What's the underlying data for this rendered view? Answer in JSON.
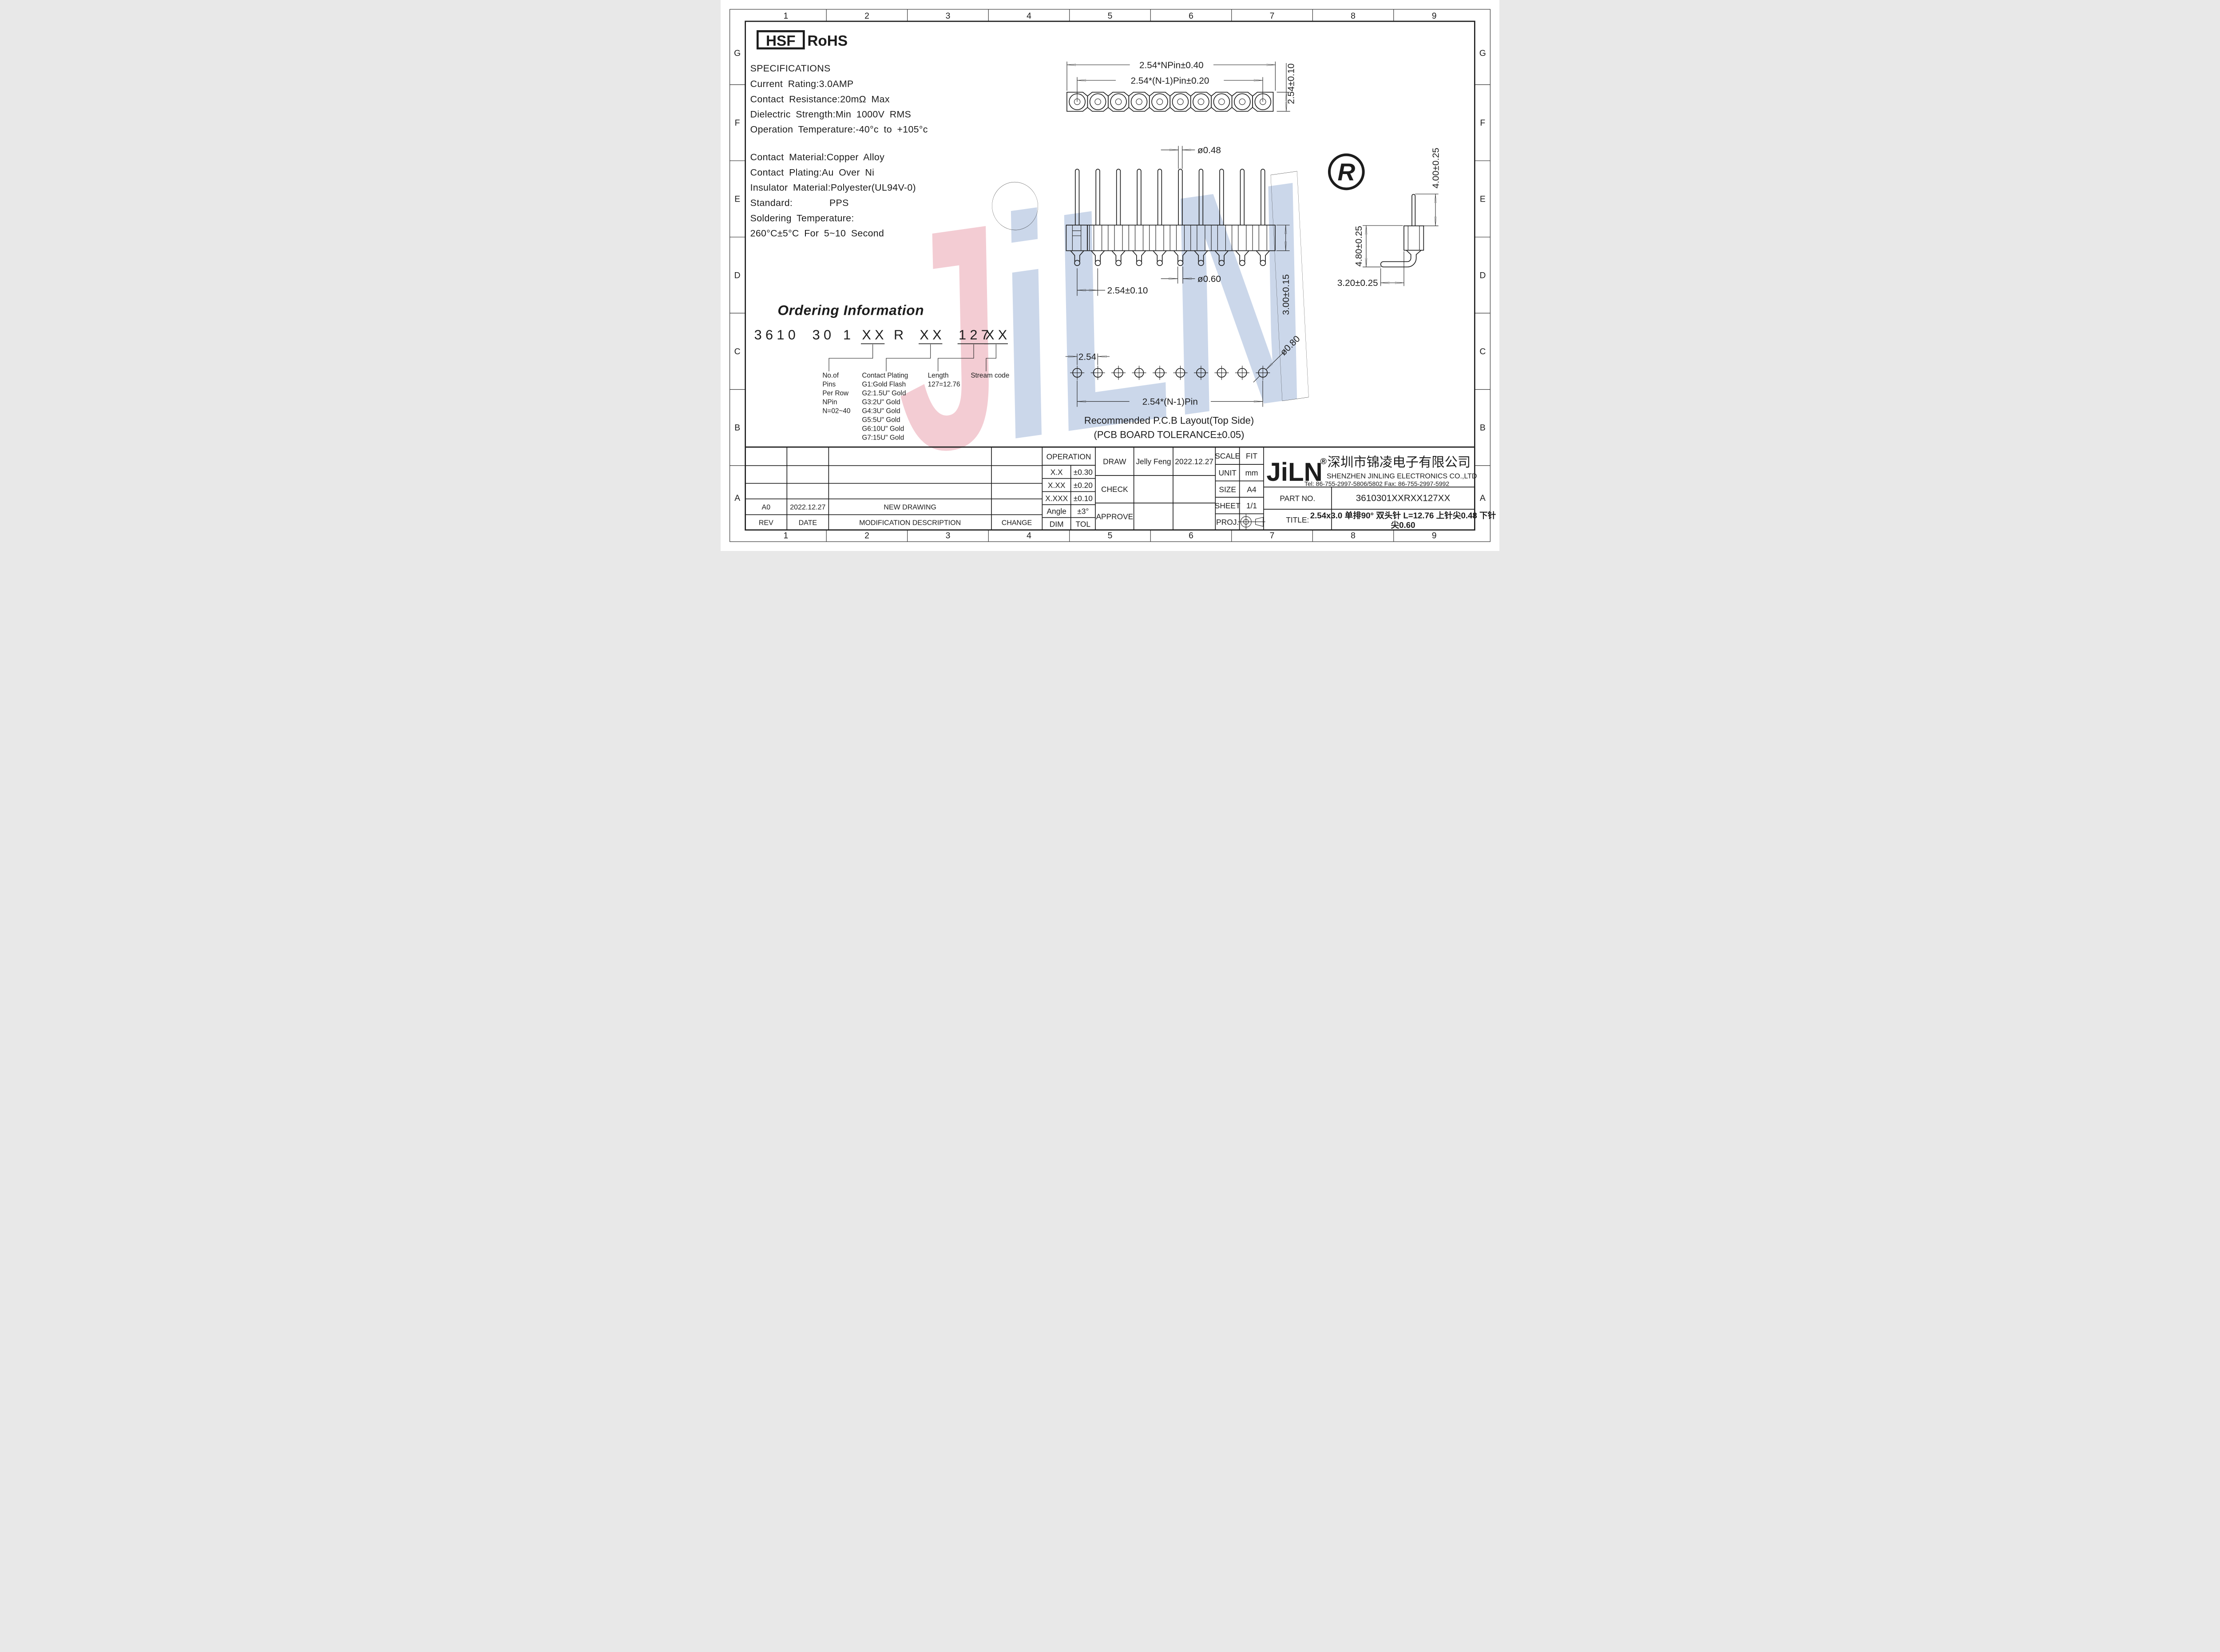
{
  "grid": {
    "columns": [
      "1",
      "2",
      "3",
      "4",
      "5",
      "6",
      "7",
      "8",
      "9"
    ],
    "rows": [
      "G",
      "F",
      "E",
      "D",
      "C",
      "B",
      "A"
    ]
  },
  "badges": {
    "hsf": "HSF",
    "rohs": "RoHS"
  },
  "specifications": {
    "title": "SPECIFICATIONS",
    "current": "Current Rating:3.0AMP",
    "resistance": "Contact Resistance:20mΩ Max",
    "dielectric": "Dielectric Strength:Min 1000V RMS",
    "operation": "Operation Temperature:-40°c to +105°c",
    "material": "Contact Material:Copper Alloy",
    "plating": "Contact Plating:Au Over Ni",
    "insulator": "Insulator Material:Polyester(UL94V-0)",
    "standard_label": "Standard:",
    "standard_value": "PPS",
    "soldering1": "Soldering Temperature:",
    "soldering2": "260°C±5°C For 5~10 Second"
  },
  "ordering": {
    "title": "Ordering Information",
    "tokens": [
      "3610",
      "30",
      "1",
      "XX",
      "R",
      "XX",
      "127",
      "XX"
    ],
    "annotations": {
      "pins": [
        "No.of",
        "Pins",
        "Per Row",
        "NPin",
        "N=02~40"
      ],
      "plating": [
        "Contact Plating",
        "G1:Gold Flash",
        "G2:1.5U\" Gold",
        "G3:2U\" Gold",
        "G4:3U\" Gold",
        "G5:5U\" Gold",
        "G6:10U\" Gold",
        "G7:15U\" Gold"
      ],
      "length": [
        "Length",
        "127=12.76"
      ],
      "stream": [
        "Stream code"
      ]
    }
  },
  "drawings": {
    "top_view": {
      "pin_count": 10,
      "dim_overall": "2.54*NPin±0.40",
      "dim_inner": "2.54*(N-1)Pin±0.20",
      "dim_height": "2.54±0.10"
    },
    "side_view": {
      "pin_count": 10,
      "dim_top_pin": "ø0.48",
      "dim_bottom_pin": "ø0.60",
      "dim_pitch": "2.54±0.10",
      "dim_body": "3.00±0.15"
    },
    "angle_view": {
      "dim_top": "4.00±0.25",
      "dim_vert": "4.80±0.25",
      "dim_horiz": "3.20±0.25"
    },
    "pcb": {
      "pin_count": 10,
      "dim_pitch": "2.54",
      "dim_overall": "2.54*(N-1)Pin",
      "dim_hole": "ø0.80",
      "caption_1": "Recommended P.C.B Layout(Top Side)",
      "caption_2": "(PCB BOARD TOLERANCE±0.05)"
    }
  },
  "title_block": {
    "operation": "OPERATION",
    "r1c1": "X.X",
    "r1c2": "±0.30",
    "r2c1": "X.XX",
    "r2c2": "±0.20",
    "r3c1": "X.XXX",
    "r3c2": "±0.10",
    "r4c1": "Angle",
    "r4c2": "±3°",
    "r5c1": "DIM",
    "r5c2": "TOL",
    "draw": "DRAW",
    "check": "CHECK",
    "approve": "APPROVE",
    "draw_name": "Jelly Feng",
    "draw_date": "2022.12.27",
    "scale_l": "SCALE",
    "scale_v": "FIT",
    "unit_l": "UNIT",
    "unit_v": "mm",
    "size_l": "SIZE",
    "size_v": "A4",
    "sheet_l": "SHEET",
    "sheet_v": "1/1",
    "proj_l": "PROJ.",
    "logo": "JiLN",
    "reg": "®",
    "company_cn": "深圳市锦凌电子有限公司",
    "company_en": "SHENZHEN JINLING ELECTRONICS CO.,LTD",
    "tel": "Tel: 86-755-2997-5806/5802  Fax: 86-755-2997-5992",
    "part_label": "PART NO.",
    "part_value": "3610301XXRXX127XX",
    "title_label": "TITLE:",
    "title_1": "2.54x3.0 单排90° 双头针 L=12.76 上针尖0.48 下针",
    "title_2": "尖0.60",
    "rev": "REV",
    "date": "DATE",
    "mod": "MODIFICATION DESCRIPTION",
    "change": "CHANGE",
    "rev_a0": "A0",
    "rev_a0_date": "2022.12.27",
    "rev_a0_desc": "NEW DRAWING"
  },
  "watermark": {
    "j": "J",
    "i": "i",
    "ln": "LN",
    "reg": "R",
    "pink": "#f3ccd3",
    "blue": "#cbd7ea",
    "red": "#e49aa3"
  }
}
